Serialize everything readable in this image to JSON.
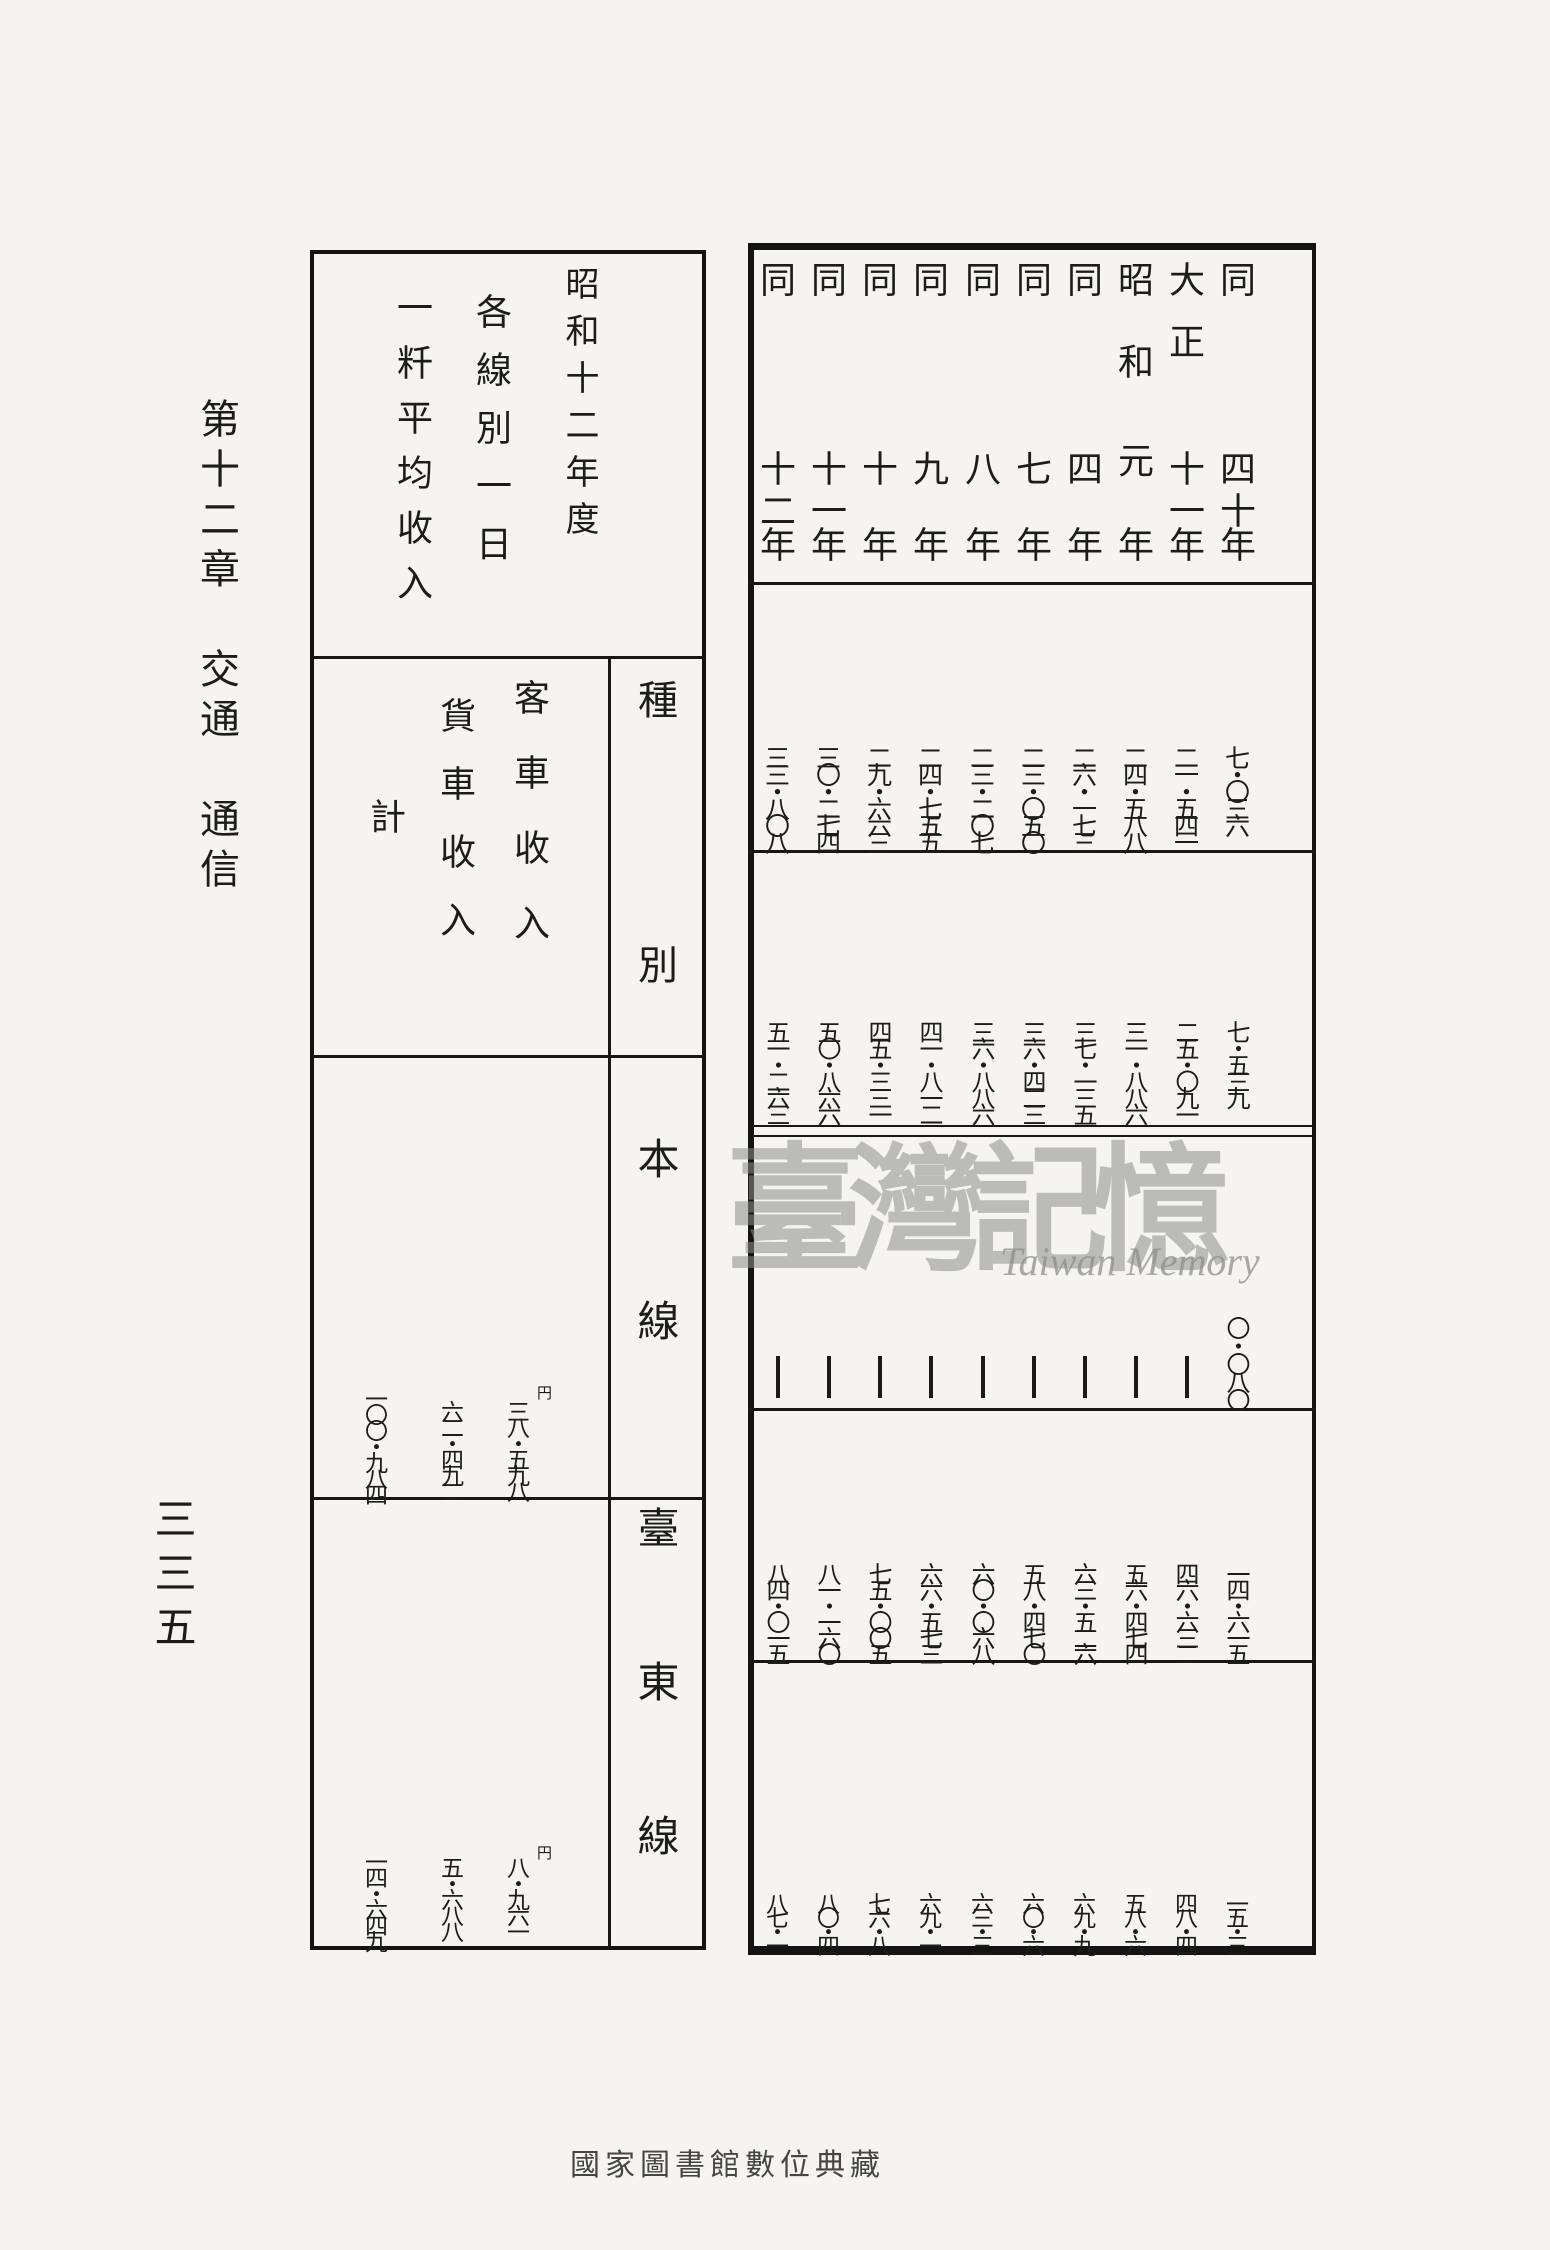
{
  "page": {
    "chapter_margin": "第十二章　交通　通信",
    "page_number": "三三五",
    "bottom_caption": "國家圖書館數位典藏"
  },
  "watermark": {
    "cjk": "臺灣記憶",
    "latin": "Taiwan Memory",
    "color": "#8f8f8a"
  },
  "left_table": {
    "titles": [
      "昭和十二年度",
      "各線別一日",
      "一粁平均收入"
    ],
    "category_header": "種別",
    "measures": [
      "客車收入",
      "貨車收入",
      "計"
    ],
    "unit": "円",
    "rows": [
      {
        "category": "本線",
        "values": [
          "三八・五九八",
          "六二・四九二",
          "一〇〇・九八四"
        ]
      },
      {
        "category": "臺東線",
        "values": [
          "八・九六一",
          "五・六八八",
          "一四・六四九"
        ]
      }
    ]
  },
  "right_table": {
    "year_suffix": "年",
    "years": [
      {
        "label": "同四十年",
        "era": "同",
        "num": "四十"
      },
      {
        "label": "大正十一年",
        "era": "大正",
        "num": "十一"
      },
      {
        "label": "昭和元年",
        "era": "昭和",
        "num": "元"
      },
      {
        "label": "同四年",
        "era": "同",
        "num": "四"
      },
      {
        "label": "同七年",
        "era": "同",
        "num": "七"
      },
      {
        "label": "同八年",
        "era": "同",
        "num": "八"
      },
      {
        "label": "同九年",
        "era": "同",
        "num": "九"
      },
      {
        "label": "同十年",
        "era": "同",
        "num": "十"
      },
      {
        "label": "同十一年",
        "era": "同",
        "num": "十一"
      },
      {
        "label": "同十二年",
        "era": "同",
        "num": "十二"
      }
    ],
    "data_rows": [
      {
        "values": [
          "七・〇三六",
          "二一・五四一",
          "二四・五八八",
          "二六・一七三",
          "二三・〇五〇",
          "二三・二〇七",
          "二四・七五五",
          "二九・六六三",
          "三〇・二七四",
          "三三・八〇八"
        ]
      },
      {
        "values": [
          "七・五三九",
          "二五・〇九一",
          "三一・八八六",
          "三七・一三五",
          "三六・四二三",
          "三六・八八六",
          "四一・八一二",
          "四五・三三一",
          "五〇・八六六",
          "五一・二六三"
        ]
      },
      {
        "values": [
          "〇・〇八〇",
          "―",
          "―",
          "―",
          "―",
          "―",
          "―",
          "―",
          "―",
          "―"
        ]
      },
      {
        "values": [
          "一四・六一五",
          "四六・六三二",
          "五六・四七四",
          "六三・五二六",
          "五八・四七〇",
          "六〇・〇六八",
          "六六・五七三",
          "七五・〇〇五",
          "八一・一六〇",
          "八四・〇一五"
        ]
      },
      {
        "values": [
          "一五・三",
          "四八・四",
          "五八・六",
          "六九・九",
          "六〇・六",
          "六三・三",
          "六九・一",
          "七六・八",
          "八〇・四",
          "八七・一"
        ]
      }
    ]
  }
}
